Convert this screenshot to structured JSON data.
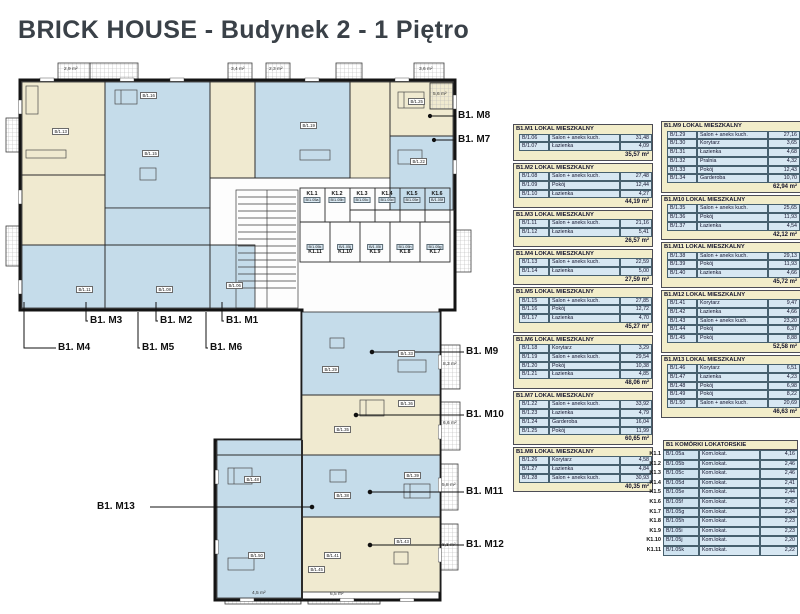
{
  "title": "BRICK HOUSE - Budynek 2 - 1 Piętro",
  "colors": {
    "wall": "#141414",
    "room_blue": "#c5dcea",
    "room_cream": "#f0ead0",
    "table_header_bg": "#f2edca",
    "table_cell_bg": "#d7e7f2",
    "title_color": "#3a4148"
  },
  "apartments": [
    {
      "header": "B1.M1 LOKAL MIESZKALNY",
      "rooms": [
        {
          "code": "B/1.06",
          "name": "Salon + aneks kuch.",
          "area": "31,48"
        },
        {
          "code": "B/1.07",
          "name": "Łazienka",
          "area": "4,09"
        }
      ],
      "total": "35,57 m²"
    },
    {
      "header": "B1.M2 LOKAL MIESZKALNY",
      "rooms": [
        {
          "code": "B/1.08",
          "name": "Salon + aneks kuch.",
          "area": "27,48"
        },
        {
          "code": "B/1.09",
          "name": "Pokój",
          "area": "12,44"
        },
        {
          "code": "B/1.10",
          "name": "Łazienka",
          "area": "4,27"
        }
      ],
      "total": "44,19 m²"
    },
    {
      "header": "B1.M3 LOKAL MIESZKALNY",
      "rooms": [
        {
          "code": "B/1.11",
          "name": "Salon + aneks kuch.",
          "area": "21,16"
        },
        {
          "code": "B/1.12",
          "name": "Łazienka",
          "area": "5,41"
        }
      ],
      "total": "26,57 m²"
    },
    {
      "header": "B1.M4 LOKAL MIESZKALNY",
      "rooms": [
        {
          "code": "B/1.13",
          "name": "Salon + aneks kuch.",
          "area": "22,59"
        },
        {
          "code": "B/1.14",
          "name": "Łazienka",
          "area": "5,00"
        }
      ],
      "total": "27,59 m²"
    },
    {
      "header": "B1.M5 LOKAL MIESZKALNY",
      "rooms": [
        {
          "code": "B/1.15",
          "name": "Salon + aneks kuch.",
          "area": "27,85"
        },
        {
          "code": "B/1.16",
          "name": "Pokój",
          "area": "12,72"
        },
        {
          "code": "B/1.17",
          "name": "Łazienka",
          "area": "4,70"
        }
      ],
      "total": "45,27 m²"
    },
    {
      "header": "B1.M6 LOKAL MIESZKALNY",
      "rooms": [
        {
          "code": "B/1.18",
          "name": "Korytarz",
          "area": "3,29"
        },
        {
          "code": "B/1.19",
          "name": "Salon + aneks kuch.",
          "area": "29,54"
        },
        {
          "code": "B/1.20",
          "name": "Pokój",
          "area": "10,38"
        },
        {
          "code": "B/1.21",
          "name": "Łazienka",
          "area": "4,85"
        }
      ],
      "total": "48,06 m²"
    },
    {
      "header": "B1.M7 LOKAL MIESZKALNY",
      "rooms": [
        {
          "code": "B/1.22",
          "name": "Salon + aneks kuch.",
          "area": "33,92"
        },
        {
          "code": "B/1.23",
          "name": "Łazienka",
          "area": "4,79"
        },
        {
          "code": "B/1.24",
          "name": "Garderoba",
          "area": "16,04"
        },
        {
          "code": "B/1.25",
          "name": "Pokój",
          "area": "11,99"
        }
      ],
      "total": "60,65 m²"
    },
    {
      "header": "B1.M8 LOKAL MIESZKALNY",
      "rooms": [
        {
          "code": "B/1.26",
          "name": "Korytarz",
          "area": "4,58"
        },
        {
          "code": "B/1.27",
          "name": "Łazienka",
          "area": "4,84"
        },
        {
          "code": "B/1.28",
          "name": "Salon + aneks kuch.",
          "area": "30,93"
        }
      ],
      "total": "40,35 m²"
    },
    {
      "header": "B1.M9 LOKAL MIESZKALNY",
      "rooms": [
        {
          "code": "B/1.29",
          "name": "Salon + aneks kuch.",
          "area": "27,16"
        },
        {
          "code": "B/1.30",
          "name": "Korytarz",
          "area": "3,65"
        },
        {
          "code": "B/1.31",
          "name": "Łazienka",
          "area": "4,68"
        },
        {
          "code": "B/1.32",
          "name": "Pralnia",
          "area": "4,32"
        },
        {
          "code": "B/1.33",
          "name": "Pokój",
          "area": "12,43"
        },
        {
          "code": "B/1.34",
          "name": "Garderoba",
          "area": "10,70"
        }
      ],
      "total": "62,94 m²"
    },
    {
      "header": "B1.M10 LOKAL MIESZKALNY",
      "rooms": [
        {
          "code": "B/1.35",
          "name": "Salon + aneks kuch.",
          "area": "25,65"
        },
        {
          "code": "B/1.36",
          "name": "Pokój",
          "area": "11,93"
        },
        {
          "code": "B/1.37",
          "name": "Łazienka",
          "area": "4,54"
        }
      ],
      "total": "42,12 m²"
    },
    {
      "header": "B1.M11 LOKAL MIESZKALNY",
      "rooms": [
        {
          "code": "B/1.38",
          "name": "Salon + aneks kuch.",
          "area": "29,13"
        },
        {
          "code": "B/1.39",
          "name": "Pokój",
          "area": "11,93"
        },
        {
          "code": "B/1.40",
          "name": "Łazienka",
          "area": "4,66"
        }
      ],
      "total": "45,72 m²"
    },
    {
      "header": "B1.M12 LOKAL MIESZKALNY",
      "rooms": [
        {
          "code": "B/1.41",
          "name": "Korytarz",
          "area": "9,47"
        },
        {
          "code": "B/1.42",
          "name": "Łazienka",
          "area": "4,66"
        },
        {
          "code": "B/1.43",
          "name": "Salon + aneks kuch.",
          "area": "23,20"
        },
        {
          "code": "B/1.44",
          "name": "Pokój",
          "area": "6,37"
        },
        {
          "code": "B/1.45",
          "name": "Pokój",
          "area": "8,88"
        }
      ],
      "total": "52,58 m²"
    },
    {
      "header": "B1.M13 LOKAL MIESZKALNY",
      "rooms": [
        {
          "code": "B/1.46",
          "name": "Korytarz",
          "area": "6,51"
        },
        {
          "code": "B/1.47",
          "name": "Łazienka",
          "area": "4,23"
        },
        {
          "code": "B/1.48",
          "name": "Pokój",
          "area": "6,98"
        },
        {
          "code": "B/1.49",
          "name": "Pokój",
          "area": "8,22"
        },
        {
          "code": "B/1.50",
          "name": "Salon + aneks kuch.",
          "area": "20,69"
        }
      ],
      "total": "46,63 m²"
    }
  ],
  "storage": {
    "title": "B1 KOMÓRKI LOKATORSKIE",
    "rows": [
      {
        "label": "K1.1",
        "code": "B/1.05a",
        "name": "Kom.lokat.",
        "area": "4,16"
      },
      {
        "label": "K1.2",
        "code": "B/1.05b",
        "name": "Kom.lokat.",
        "area": "2,46"
      },
      {
        "label": "K1.3",
        "code": "B/1.05c",
        "name": "Kom.lokat.",
        "area": "2,46"
      },
      {
        "label": "K1.4",
        "code": "B/1.05d",
        "name": "Kom.lokat.",
        "area": "2,41"
      },
      {
        "label": "K1.5",
        "code": "B/1.05e",
        "name": "Kom.lokat.",
        "area": "2,44"
      },
      {
        "label": "K1.6",
        "code": "B/1.05f",
        "name": "Kom.lokat.",
        "area": "2,45"
      },
      {
        "label": "K1.7",
        "code": "B/1.05g",
        "name": "Kom.lokat.",
        "area": "2,24"
      },
      {
        "label": "K1.8",
        "code": "B/1.05h",
        "name": "Kom.lokat.",
        "area": "2,23"
      },
      {
        "label": "K1.9",
        "code": "B/1.05i",
        "name": "Kom.lokat.",
        "area": "2,23"
      },
      {
        "label": "K1.10",
        "code": "B/1.05j",
        "name": "Kom.lokat.",
        "area": "2,20"
      },
      {
        "label": "K1.11",
        "code": "B/1.05k",
        "name": "Kom.lokat.",
        "area": "2,22"
      }
    ]
  },
  "plan": {
    "callouts": [
      {
        "label": "B1. M8",
        "x": 458,
        "y": 110
      },
      {
        "label": "B1. M7",
        "x": 458,
        "y": 134
      },
      {
        "label": "B1. M3",
        "x": 90,
        "y": 315
      },
      {
        "label": "B1. M2",
        "x": 160,
        "y": 315
      },
      {
        "label": "B1. M1",
        "x": 226,
        "y": 315
      },
      {
        "label": "B1. M4",
        "x": 58,
        "y": 342
      },
      {
        "label": "B1. M5",
        "x": 142,
        "y": 342
      },
      {
        "label": "B1. M6",
        "x": 210,
        "y": 342
      },
      {
        "label": "B1. M9",
        "x": 466,
        "y": 346
      },
      {
        "label": "B1. M10",
        "x": 466,
        "y": 409
      },
      {
        "label": "B1. M11",
        "x": 466,
        "y": 486
      },
      {
        "label": "B1. M12",
        "x": 466,
        "y": 539
      },
      {
        "label": "B1. M13",
        "x": 97,
        "y": 501
      }
    ],
    "storage_units": [
      {
        "label": "K1.1",
        "code": "B/1.05a",
        "x": 312,
        "y": 192,
        "flip": false
      },
      {
        "label": "K1.2",
        "code": "B/1.05b",
        "x": 337,
        "y": 192,
        "flip": false
      },
      {
        "label": "K1.3",
        "code": "B/1.05c",
        "x": 362,
        "y": 192,
        "flip": false
      },
      {
        "label": "K1.4",
        "code": "B/1.05d",
        "x": 387,
        "y": 192,
        "flip": false
      },
      {
        "label": "K1.5",
        "code": "B/1.05e",
        "x": 412,
        "y": 192,
        "flip": false
      },
      {
        "label": "K1.6",
        "code": "B/1.05f",
        "x": 437,
        "y": 192,
        "flip": false
      },
      {
        "label": "K1.11",
        "code": "B/1.05k",
        "x": 315,
        "y": 244,
        "flip": true
      },
      {
        "label": "K1.10",
        "code": "B/1.05j",
        "x": 345,
        "y": 244,
        "flip": true
      },
      {
        "label": "K1.9",
        "code": "B/1.05i",
        "x": 375,
        "y": 244,
        "flip": true
      },
      {
        "label": "K1.8",
        "code": "B/1.05h",
        "x": 405,
        "y": 244,
        "flip": true
      },
      {
        "label": "K1.7",
        "code": "B/1.05g",
        "x": 435,
        "y": 244,
        "flip": true
      }
    ],
    "room_codes": [
      {
        "t": "B/1.16",
        "x": 140,
        "y": 92
      },
      {
        "t": "B/1.15",
        "x": 142,
        "y": 150
      },
      {
        "t": "B/1.13",
        "x": 52,
        "y": 128
      },
      {
        "t": "B/1.19",
        "x": 300,
        "y": 122
      },
      {
        "t": "B/1.25",
        "x": 408,
        "y": 98
      },
      {
        "t": "B/1.22",
        "x": 410,
        "y": 158
      },
      {
        "t": "B/1.11",
        "x": 76,
        "y": 286
      },
      {
        "t": "B/1.08",
        "x": 156,
        "y": 286
      },
      {
        "t": "B/1.06",
        "x": 226,
        "y": 282
      },
      {
        "t": "B/1.29",
        "x": 322,
        "y": 366
      },
      {
        "t": "B/1.33",
        "x": 398,
        "y": 350
      },
      {
        "t": "B/1.35",
        "x": 334,
        "y": 426
      },
      {
        "t": "B/1.36",
        "x": 398,
        "y": 400
      },
      {
        "t": "B/1.38",
        "x": 334,
        "y": 492
      },
      {
        "t": "B/1.39",
        "x": 404,
        "y": 472
      },
      {
        "t": "B/1.41",
        "x": 324,
        "y": 552
      },
      {
        "t": "B/1.43",
        "x": 394,
        "y": 538
      },
      {
        "t": "B/1.48",
        "x": 244,
        "y": 476
      },
      {
        "t": "B/1.50",
        "x": 248,
        "y": 552
      },
      {
        "t": "B/1.45",
        "x": 308,
        "y": 566
      }
    ],
    "area_labels": [
      {
        "t": "2,9 m²",
        "x": 64,
        "y": 67
      },
      {
        "t": "3,4 m²",
        "x": 231,
        "y": 67
      },
      {
        "t": "2,3 m²",
        "x": 269,
        "y": 67
      },
      {
        "t": "3,6 m²",
        "x": 419,
        "y": 67
      },
      {
        "t": "5,6 m²",
        "x": 433,
        "y": 92
      },
      {
        "t": "8,3 m²",
        "x": 443,
        "y": 362
      },
      {
        "t": "6,6 m²",
        "x": 443,
        "y": 421
      },
      {
        "t": "5,8 m²",
        "x": 442,
        "y": 483
      },
      {
        "t": "8,3 m²",
        "x": 442,
        "y": 543
      },
      {
        "t": "4,5 m²",
        "x": 252,
        "y": 591
      },
      {
        "t": "6,5 m²",
        "x": 330,
        "y": 592
      }
    ]
  }
}
